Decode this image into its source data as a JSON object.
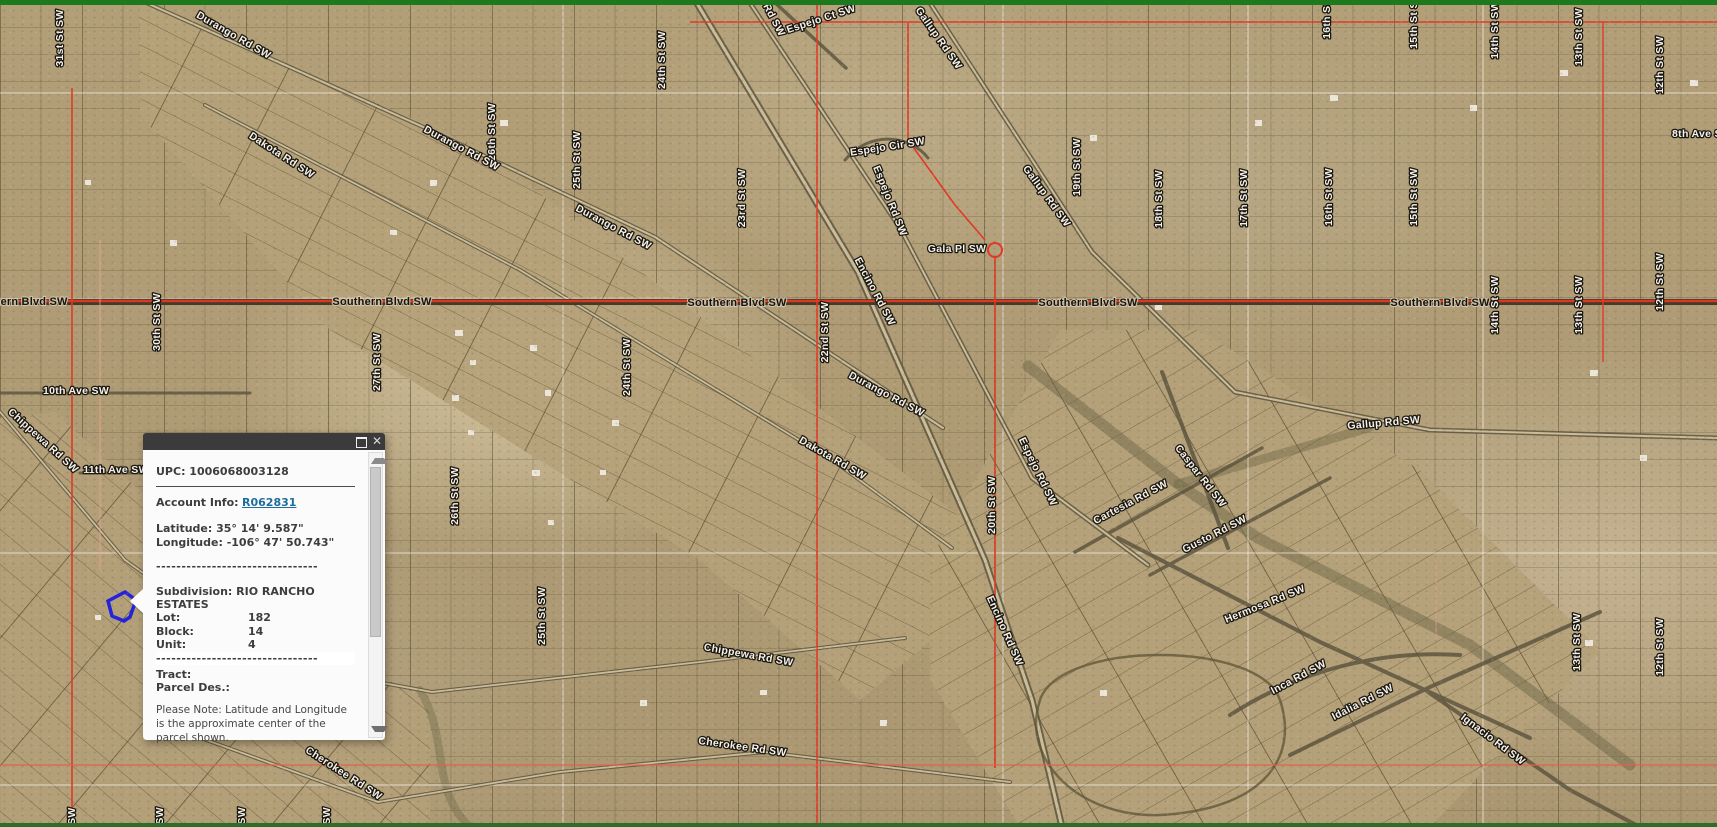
{
  "popup": {
    "upc": "UPC: 1006068003128",
    "account_info_label": "Account Info:",
    "account_link": "R062831",
    "latitude": "Latitude: 35° 14' 9.587\"",
    "longitude": "Longitude: -106° 47' 50.743\"",
    "divider": "--------------------------------",
    "subdivision": "Subdivision: RIO RANCHO ESTATES",
    "fields": {
      "lot_label": "Lot:",
      "lot": "182",
      "block_label": "Block:",
      "block": "14",
      "unit_label": "Unit:",
      "unit": "4"
    },
    "tract_label": "Tract:",
    "parcel_des_label": "Parcel Des.:",
    "note": "Please Note: Latitude and Longitude is the approximate center of the parcel shown.",
    "close_glyph": "✕"
  },
  "map": {
    "colors": {
      "boundary_red": "#dd3a26",
      "southern_blvd_red": "#da3827",
      "highlight_blue": "#2323dd",
      "section_line_white": "#ffffff",
      "desert_tan": "#b29f78",
      "top_border_green": "#1c7a1c"
    },
    "highlighted_parcel": {
      "subdivision": "RIO RANCHO ESTATES",
      "lot": "182",
      "block": "14",
      "unit": "4"
    },
    "labels": [
      {
        "t": "31st St SW",
        "x": 63,
        "y": 38,
        "r": -90
      },
      {
        "t": "30th St SW",
        "x": 160,
        "y": 322,
        "r": -90
      },
      {
        "t": "27th St SW",
        "x": 380,
        "y": 362,
        "r": -90
      },
      {
        "t": "26th St SW",
        "x": 495,
        "y": 132,
        "r": -90
      },
      {
        "t": "26th St SW",
        "x": 458,
        "y": 496,
        "r": -90
      },
      {
        "t": "25th St SW",
        "x": 580,
        "y": 160,
        "r": -90
      },
      {
        "t": "25th St SW",
        "x": 545,
        "y": 616,
        "r": -90
      },
      {
        "t": "24th St SW",
        "x": 665,
        "y": 60,
        "r": -90
      },
      {
        "t": "24th St SW",
        "x": 630,
        "y": 367,
        "r": -90
      },
      {
        "t": "23rd St SW",
        "x": 745,
        "y": 198,
        "r": -90
      },
      {
        "t": "22nd St SW",
        "x": 828,
        "y": 332,
        "r": -90
      },
      {
        "t": "20th St SW",
        "x": 995,
        "y": 505,
        "r": -90
      },
      {
        "t": "19th St SW",
        "x": 1080,
        "y": 167,
        "r": -90
      },
      {
        "t": "18th St SW",
        "x": 1162,
        "y": 199,
        "r": -90
      },
      {
        "t": "17th St SW",
        "x": 1247,
        "y": 198,
        "r": -90
      },
      {
        "t": "16th St SW",
        "x": 1330,
        "y": 10,
        "r": -90
      },
      {
        "t": "16th St SW",
        "x": 1332,
        "y": 197,
        "r": -90
      },
      {
        "t": "15th St SW",
        "x": 1417,
        "y": 20,
        "r": -90
      },
      {
        "t": "15th St SW",
        "x": 1417,
        "y": 197,
        "r": -90
      },
      {
        "t": "14th St SW",
        "x": 1498,
        "y": 30,
        "r": -90
      },
      {
        "t": "14th St SW",
        "x": 1498,
        "y": 305,
        "r": -90
      },
      {
        "t": "13th St SW",
        "x": 1582,
        "y": 37,
        "r": -90
      },
      {
        "t": "13th St SW",
        "x": 1582,
        "y": 305,
        "r": -90
      },
      {
        "t": "13th St SW",
        "x": 1580,
        "y": 642,
        "r": -90
      },
      {
        "t": "12th St SW",
        "x": 1663,
        "y": 65,
        "r": -90
      },
      {
        "t": "12th St SW",
        "x": 1663,
        "y": 282,
        "r": -90
      },
      {
        "t": "12th St SW",
        "x": 1663,
        "y": 647,
        "r": -90
      },
      {
        "t": "31st St SW",
        "x": 75,
        "y": 836,
        "r": -90
      },
      {
        "t": "30th St SW",
        "x": 163,
        "y": 836,
        "r": -90
      },
      {
        "t": "29th St SW",
        "x": 245,
        "y": 836,
        "r": -90
      },
      {
        "t": "28th St SW",
        "x": 330,
        "y": 836,
        "r": -90
      },
      {
        "t": "10th Ave SW",
        "x": 76,
        "y": 394,
        "r": 0
      },
      {
        "t": "11th Ave SW",
        "x": 116,
        "y": 473,
        "r": 0
      },
      {
        "t": "8th Ave SW",
        "x": 1702,
        "y": 137,
        "r": 0
      },
      {
        "t": "Durango Rd SW",
        "x": 232,
        "y": 38,
        "r": 30
      },
      {
        "t": "Durango Rd SW",
        "x": 460,
        "y": 151,
        "r": 28
      },
      {
        "t": "Durango Rd SW",
        "x": 612,
        "y": 230,
        "r": 28
      },
      {
        "t": "Durango Rd SW",
        "x": 885,
        "y": 397,
        "r": 28
      },
      {
        "t": "Dakota Rd SW",
        "x": 280,
        "y": 158,
        "r": 33
      },
      {
        "t": "Dakota Rd SW",
        "x": 831,
        "y": 461,
        "r": 30
      },
      {
        "t": "Chippewa Rd SW",
        "x": 41,
        "y": 443,
        "r": 42
      },
      {
        "t": "Chippewa Rd SW",
        "x": 748,
        "y": 658,
        "r": 10
      },
      {
        "t": "Cherokee Rd SW",
        "x": 342,
        "y": 776,
        "r": 33
      },
      {
        "t": "Cherokee Rd SW",
        "x": 742,
        "y": 750,
        "r": 8
      },
      {
        "t": "Encino Rd SW",
        "x": 872,
        "y": 293,
        "r": 62
      },
      {
        "t": "Encino Rd SW",
        "x": 1002,
        "y": 632,
        "r": 66
      },
      {
        "t": "Espejo Rd SW",
        "x": 762,
        "y": 4,
        "r": 62
      },
      {
        "t": "Espejo Rd SW",
        "x": 887,
        "y": 202,
        "r": 68
      },
      {
        "t": "Espejo Rd SW",
        "x": 1035,
        "y": 473,
        "r": 64
      },
      {
        "t": "Espejo Ct SW",
        "x": 822,
        "y": 22,
        "r": -18
      },
      {
        "t": "Espejo Cir SW",
        "x": 888,
        "y": 150,
        "r": -9
      },
      {
        "t": "Gallup Rd SW",
        "x": 936,
        "y": 40,
        "r": 55
      },
      {
        "t": "Gallup Rd SW",
        "x": 1044,
        "y": 198,
        "r": 54
      },
      {
        "t": "Gallup Rd SW",
        "x": 1384,
        "y": 426,
        "r": -5
      },
      {
        "t": "Gala Pl SW",
        "x": 957,
        "y": 252,
        "r": 0
      },
      {
        "t": "Cartesia Rd SW",
        "x": 1132,
        "y": 505,
        "r": -28
      },
      {
        "t": "Caspar Rd SW",
        "x": 1198,
        "y": 478,
        "r": 52
      },
      {
        "t": "Gusto Rd SW",
        "x": 1216,
        "y": 537,
        "r": -27
      },
      {
        "t": "Hermosa Rd SW",
        "x": 1266,
        "y": 607,
        "r": -22
      },
      {
        "t": "Inca Rd SW",
        "x": 1300,
        "y": 680,
        "r": -28
      },
      {
        "t": "Idalia Rd SW",
        "x": 1364,
        "y": 705,
        "r": -27
      },
      {
        "t": "Ignacio Rd SW",
        "x": 1491,
        "y": 742,
        "r": 37
      },
      {
        "t": "Southern Blvd SW",
        "x": 18,
        "y": 305,
        "r": 0,
        "v": "blvd"
      },
      {
        "t": "Southern Blvd SW",
        "x": 382,
        "y": 305,
        "r": 0,
        "v": "blvd"
      },
      {
        "t": "Southern Blvd SW",
        "x": 737,
        "y": 306,
        "r": 0,
        "v": "blvd"
      },
      {
        "t": "Southern Blvd SW",
        "x": 1088,
        "y": 306,
        "r": 0,
        "v": "blvd"
      },
      {
        "t": "Southern Blvd SW",
        "x": 1440,
        "y": 306,
        "r": 0,
        "v": "blvd"
      }
    ]
  }
}
